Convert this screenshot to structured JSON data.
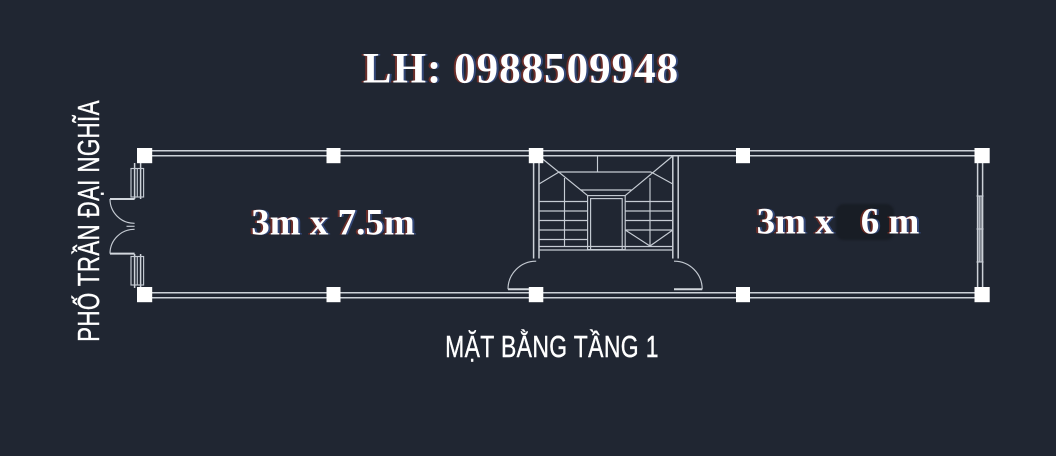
{
  "header": {
    "title": "LH: 0988509948"
  },
  "street": {
    "label": "PHỐ TRẦN ĐẠI NGHĨA"
  },
  "caption": {
    "label": "MẶT BẰNG TẦNG 1"
  },
  "rooms": {
    "left": {
      "label": "3m x 7.5m"
    },
    "right": {
      "label_prefix": "3m x",
      "label_suffix": "6 m"
    }
  },
  "plan": {
    "background_color": "#202632",
    "line_color": "#ccd1d8",
    "column_color": "#ffffff",
    "erased_patch_color": "#181d25",
    "text_color": "#ffffff"
  }
}
